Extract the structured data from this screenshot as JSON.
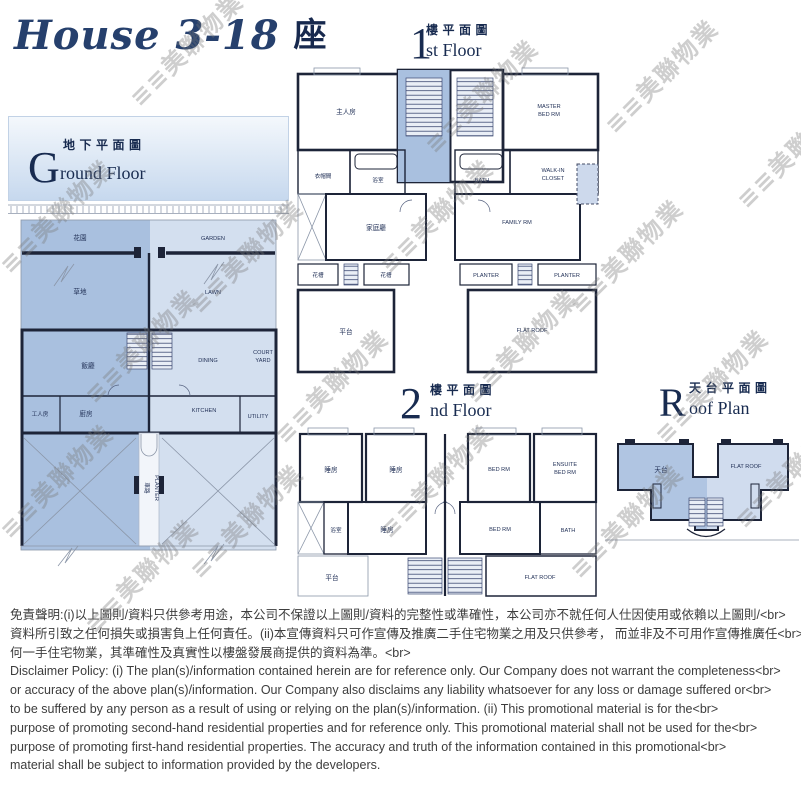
{
  "title": {
    "script": "House 3-18",
    "suffix": "座"
  },
  "watermark": {
    "text": "≡≡美聯物業"
  },
  "plans": {
    "ground": {
      "big": "G",
      "cn": "地下平面圖",
      "en": "round Floor",
      "labels": {
        "garden_cn": "花園",
        "garden_en": "GARDEN",
        "lawn_cn": "草地",
        "lawn_en": "LAWN",
        "dining_cn": "飯廳",
        "dining_en": "DINING",
        "court1": "COURT",
        "court2": "YARD",
        "kitchen_cn": "廚房",
        "kitchen_en": "KITCHEN",
        "utility_cn": "工人房",
        "utility_en": "UTILITY",
        "drive_cn": "車路",
        "planter_en": "PLANTER"
      }
    },
    "first": {
      "big": "1",
      "cn": "樓平面圖",
      "en": "st Floor",
      "labels": {
        "master_cn": "主人房",
        "master_en1": "MASTER",
        "master_en2": "BED RM",
        "closet_cn": "衣帽間",
        "bath_cn": "浴室",
        "bath_en": "BATH",
        "wic1": "WALK-IN",
        "wic2": "CLOSET",
        "family_cn": "家庭廳",
        "family_en": "FAMILY RM",
        "planter_cn": "花槽",
        "planter_en": "PLANTER",
        "terrace_cn": "平台",
        "flatroof_en": "FLAT ROOF"
      }
    },
    "second": {
      "big": "2",
      "cn": "樓平面圖",
      "en": "nd Floor",
      "labels": {
        "bed_cn": "睡房",
        "bed_en": "BED RM",
        "ensuite1": "ENSUITE",
        "ensuite2": "BED RM",
        "bath_cn": "浴室",
        "bath_en": "BATH",
        "terrace_cn": "平台",
        "flatroof_en": "FLAT ROOF"
      }
    },
    "roof": {
      "big": "R",
      "cn": "天台平面圖",
      "en": "oof Plan",
      "labels": {
        "roof_cn": "天台",
        "flatroof_en": "FLAT ROOF"
      }
    }
  },
  "disclaimer": {
    "lines": [
      "免責聲明:(i)以上圖則/資料只供參考用途，本公司不保證以上圖則/資料的完整性或準確性，本公司亦不就任何人仕因使用或依賴以上圖則/<br>",
      "資料所引致之任何損失或損害負上任何責任。(ii)本宣傳資料只可作宣傳及推廣二手住宅物業之用及只供參考， 而並非及不可用作宣傳推廣任<br>",
      "何一手住宅物業，其準確性及真實性以樓盤發展商提供的資料為準。<br>",
      "Disclaimer Policy: (i) The plan(s)/information contained herein are for reference only. Our Company does not warrant the completeness<br>",
      "or accuracy of the above plan(s)/information. Our Company also disclaims any liability whatsoever for any loss or damage suffered or<br>",
      "to be suffered by any person as a result of using or relying on the plan(s)/information. (ii) This promotional material is for the<br>",
      "purpose of promoting second-hand residential properties and for reference only. This promotional material shall not be used for the<br>",
      "purpose of promoting first-hand residential properties. The accuracy and truth of the information contained in this promotional<br>",
      "material shall be subject to information provided by the developers."
    ]
  },
  "colors": {
    "navy_text": "#182b50",
    "wall": "#1d2438",
    "unit_left": "#a9c0df",
    "unit_right": "#d3dfef",
    "terrace_dark": "#9db7db",
    "flatroof_light": "#d8e2f1",
    "watermark_gray": "#787878"
  }
}
